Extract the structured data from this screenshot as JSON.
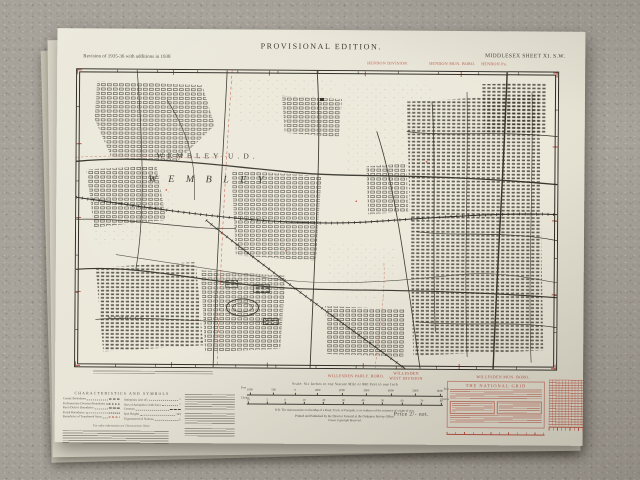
{
  "sheet": {
    "edition": "PROVISIONAL EDITION.",
    "revision_note": "Revision of 1935-36 with additions in 1938",
    "sheet_ref": "MIDDLESEX SHEET XI. S.W.",
    "price": "Price 2/- net."
  },
  "margin_labels": {
    "top": [
      "HENDON DIVISION",
      "HENDON MUN. BORO.",
      "HENDON Pa."
    ],
    "bottom": [
      "WILLESDEN PARLY. BORO.",
      "WILLESDEN",
      "WEST DIVISION",
      "WILLESDEN MUN. BORO."
    ]
  },
  "map": {
    "labels": {
      "district": "WEMBLEY U.D.",
      "town": "W E M B L E Y",
      "town_small": "WEMBLEY"
    }
  },
  "legend": {
    "heading": "CHARACTERISTICS AND SYMBOLS",
    "left_items": [
      "County Boundaries",
      "Parliamentary Division Boundaries",
      "Rural District Boundaries",
      "Parish Boundaries",
      "Boundaries of Transferred Areas"
    ],
    "right_items": [
      "Antiquities (site of)",
      "Sites of Antiquities (with date)",
      "Contours",
      "Spot Heights",
      "Trigonometrical Stations"
    ],
    "trig_symbol": "△",
    "note": "For other information see Characteristic Sheet."
  },
  "scale": {
    "caption": "Scale: Six Inches to one Statute Mile or 880 Feet to one Inch",
    "feet_label": "Feet",
    "chains_label": "Chains",
    "feet_ticks": [
      "1000",
      "500",
      "0",
      "1000",
      "2000",
      "3000",
      "4000",
      "5000",
      "6000"
    ],
    "chain_ticks": [
      "10",
      "5",
      "0",
      "10",
      "20",
      "30",
      "40",
      "50",
      "60",
      "70",
      "80"
    ],
    "footpath_note": "N.B. The representation on this Map of a Road, Track, or Footpath, is no evidence of the existence of a right of way.",
    "imprint": "Printed and Published by the Director General at the Ordnance Survey Office,",
    "copyright": "Crown Copyright Reserved."
  },
  "national_grid": {
    "title": "THE NATIONAL GRID"
  }
}
